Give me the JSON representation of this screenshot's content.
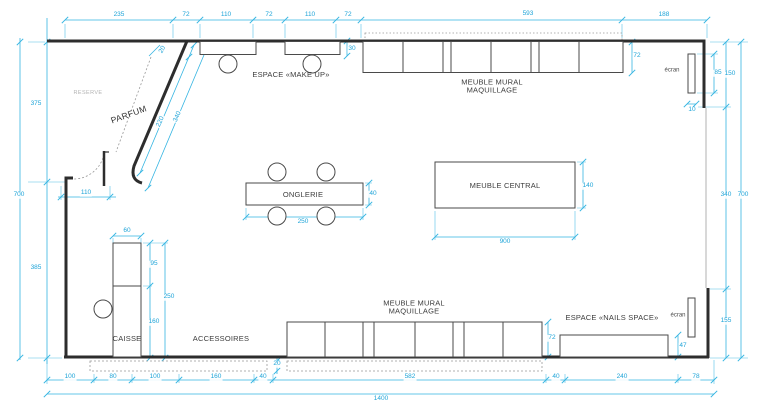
{
  "drawing": {
    "type": "floor-plan",
    "colors": {
      "dimension_accent": "#1ea4d8",
      "wall": "#2d2d2d",
      "furniture_outline": "#4a4a4a",
      "dashed_zone": "#999999",
      "muted_text": "#b3b3b3",
      "background": "#ffffff"
    }
  },
  "annotations": [
    {
      "n": "dim-top-235",
      "t": "235",
      "x": 119,
      "y": 15,
      "c": "dim"
    },
    {
      "n": "dim-top-72a",
      "t": "72",
      "x": 186,
      "y": 15,
      "c": "dim"
    },
    {
      "n": "dim-top-110a",
      "t": "110",
      "x": 226,
      "y": 15,
      "c": "dim"
    },
    {
      "n": "dim-top-72b",
      "t": "72",
      "x": 269,
      "y": 15,
      "c": "dim"
    },
    {
      "n": "dim-top-110b",
      "t": "110",
      "x": 310,
      "y": 15,
      "c": "dim"
    },
    {
      "n": "dim-top-72c",
      "t": "72",
      "x": 348,
      "y": 15,
      "c": "dim"
    },
    {
      "n": "dim-top-593",
      "t": "593",
      "x": 528,
      "y": 14,
      "c": "dim"
    },
    {
      "n": "dim-top-188",
      "t": "188",
      "x": 664,
      "y": 15,
      "c": "dim"
    },
    {
      "n": "dim-left-375",
      "t": "375",
      "x": 36,
      "y": 104,
      "c": "dim"
    },
    {
      "n": "dim-left-700",
      "t": "700",
      "x": 19,
      "y": 195,
      "c": "dim"
    },
    {
      "n": "dim-left-385",
      "t": "385",
      "x": 36,
      "y": 268,
      "c": "dim"
    },
    {
      "n": "dim-door-110",
      "t": "110",
      "x": 86,
      "y": 193,
      "c": "dim"
    },
    {
      "n": "dim-diag-20",
      "t": "20",
      "x": 163,
      "y": 50,
      "c": "dim",
      "r": -60
    },
    {
      "n": "dim-diag-220",
      "t": "220",
      "x": 161,
      "y": 122,
      "c": "dim",
      "r": -66
    },
    {
      "n": "dim-diag-340",
      "t": "340",
      "x": 178,
      "y": 117,
      "c": "dim",
      "r": -66
    },
    {
      "n": "dim-makeup-30",
      "t": "30",
      "x": 352,
      "y": 49,
      "c": "dim"
    },
    {
      "n": "dim-mural-top-72",
      "t": "72",
      "x": 637,
      "y": 56,
      "c": "dim"
    },
    {
      "n": "label-espace-makeup",
      "t": "ESPACE «MAKE UP»",
      "x": 291,
      "y": 75,
      "c": "room"
    },
    {
      "n": "label-mural-top",
      "t": "MEUBLE MURAL\nMAQUILLAGE",
      "x": 492,
      "y": 87,
      "c": "room"
    },
    {
      "n": "label-ecran-top",
      "t": "écran",
      "x": 672,
      "y": 71,
      "c": "room-sm"
    },
    {
      "n": "dim-ecran-85",
      "t": "85",
      "x": 718,
      "y": 73,
      "c": "dim"
    },
    {
      "n": "dim-right-150",
      "t": "150",
      "x": 730,
      "y": 74,
      "c": "dim"
    },
    {
      "n": "dim-ecran-10",
      "t": "10",
      "x": 692,
      "y": 110,
      "c": "dim"
    },
    {
      "n": "dim-right-340",
      "t": "340",
      "x": 726,
      "y": 195,
      "c": "dim"
    },
    {
      "n": "dim-right-700",
      "t": "700",
      "x": 743,
      "y": 195,
      "c": "dim"
    },
    {
      "n": "dim-right-155",
      "t": "155",
      "x": 726,
      "y": 321,
      "c": "dim"
    },
    {
      "n": "label-reserve",
      "t": "RESERVE",
      "x": 88,
      "y": 93,
      "c": "muted"
    },
    {
      "n": "label-parfum",
      "t": "PARFUM",
      "x": 129,
      "y": 115,
      "c": "room-lg",
      "r": -20
    },
    {
      "n": "label-onglerie",
      "t": "ONGLERIE",
      "x": 303,
      "y": 195,
      "c": "room"
    },
    {
      "n": "dim-onglerie-250",
      "t": "250",
      "x": 303,
      "y": 222,
      "c": "dim"
    },
    {
      "n": "dim-onglerie-40",
      "t": "40",
      "x": 373,
      "y": 194,
      "c": "dim"
    },
    {
      "n": "label-meuble-central",
      "t": "MEUBLE CENTRAL",
      "x": 505,
      "y": 186,
      "c": "room"
    },
    {
      "n": "dim-central-900",
      "t": "900",
      "x": 505,
      "y": 242,
      "c": "dim"
    },
    {
      "n": "dim-central-140",
      "t": "140",
      "x": 588,
      "y": 186,
      "c": "dim"
    },
    {
      "n": "dim-caisse-60",
      "t": "60",
      "x": 127,
      "y": 231,
      "c": "dim"
    },
    {
      "n": "dim-caisse-95",
      "t": "95",
      "x": 154,
      "y": 264,
      "c": "dim"
    },
    {
      "n": "dim-caisse-250",
      "t": "250",
      "x": 169,
      "y": 297,
      "c": "dim"
    },
    {
      "n": "dim-caisse-160",
      "t": "160",
      "x": 154,
      "y": 322,
      "c": "dim"
    },
    {
      "n": "label-caisse",
      "t": "CAISSE",
      "x": 127,
      "y": 339,
      "c": "room"
    },
    {
      "n": "label-accessoires",
      "t": "ACCESSOIRES",
      "x": 221,
      "y": 339,
      "c": "room"
    },
    {
      "n": "dim-accessoires-20",
      "t": "20",
      "x": 277,
      "y": 364,
      "c": "dim"
    },
    {
      "n": "label-mural-bottom",
      "t": "MEUBLE MURAL\nMAQUILLAGE",
      "x": 414,
      "y": 308,
      "c": "room"
    },
    {
      "n": "dim-mural-bottom-72",
      "t": "72",
      "x": 552,
      "y": 338,
      "c": "dim"
    },
    {
      "n": "label-nails-space",
      "t": "ESPACE «NAILS SPACE»",
      "x": 612,
      "y": 318,
      "c": "room"
    },
    {
      "n": "label-ecran-bottom",
      "t": "écran",
      "x": 678,
      "y": 316,
      "c": "room-sm"
    },
    {
      "n": "dim-nails-47",
      "t": "47",
      "x": 683,
      "y": 346,
      "c": "dim"
    },
    {
      "n": "dim-bottom-100a",
      "t": "100",
      "x": 70,
      "y": 377,
      "c": "dim"
    },
    {
      "n": "dim-bottom-80",
      "t": "80",
      "x": 113,
      "y": 377,
      "c": "dim"
    },
    {
      "n": "dim-bottom-100b",
      "t": "100",
      "x": 155,
      "y": 377,
      "c": "dim"
    },
    {
      "n": "dim-bottom-160",
      "t": "160",
      "x": 216,
      "y": 377,
      "c": "dim"
    },
    {
      "n": "dim-bottom-40a",
      "t": "40",
      "x": 263,
      "y": 377,
      "c": "dim"
    },
    {
      "n": "dim-bottom-582",
      "t": "582",
      "x": 410,
      "y": 377,
      "c": "dim"
    },
    {
      "n": "dim-bottom-40b",
      "t": "40",
      "x": 556,
      "y": 377,
      "c": "dim"
    },
    {
      "n": "dim-bottom-240",
      "t": "240",
      "x": 622,
      "y": 377,
      "c": "dim"
    },
    {
      "n": "dim-bottom-78",
      "t": "78",
      "x": 696,
      "y": 377,
      "c": "dim"
    },
    {
      "n": "dim-bottom-1400",
      "t": "1400",
      "x": 381,
      "y": 399,
      "c": "dim"
    }
  ]
}
